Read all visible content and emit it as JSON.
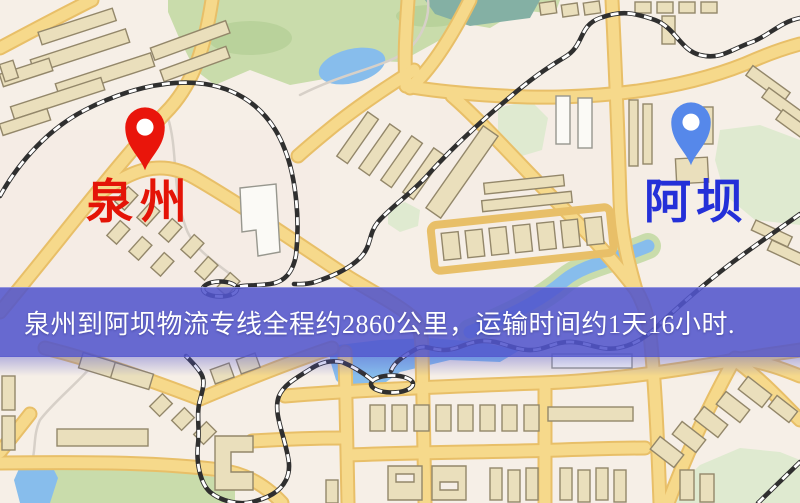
{
  "map": {
    "origin": {
      "label": "泉州"
    },
    "destination": {
      "label": "阿坝"
    }
  },
  "banner": {
    "text": "泉州到阿坝物流专线全程约2860公里，运输时间约1天16小时."
  },
  "colors": {
    "origin_pin": "#e9150b",
    "origin_label": "#e41407",
    "destination_pin": "#5688ea",
    "destination_label": "#2430d8",
    "banner_background": "rgba(82,85,205,0.87)",
    "banner_text": "#ffffff",
    "background": "#f6efe7",
    "road": "#f6d98b",
    "road_casing": "#e8bf68",
    "park": "#c9dcab",
    "park_dark": "#b9d29b",
    "park_pale": "#dfead0",
    "water": "#87bdec",
    "water_teal": "#84b0a4",
    "building": "#eadfbc",
    "building_stroke": "#93876a",
    "building_white": "#fbfaf6",
    "rail": "#2f2f2f",
    "rail_dash": "#ffffff",
    "minor_path": "#d7d0c8"
  }
}
